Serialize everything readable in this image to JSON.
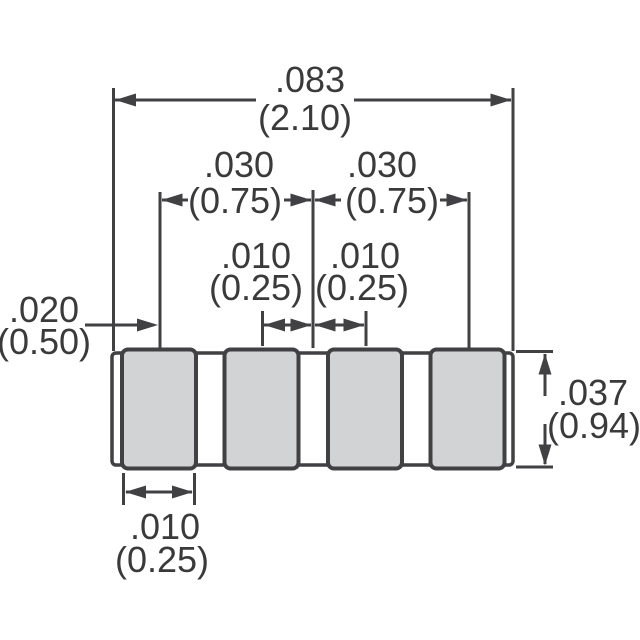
{
  "diagram": {
    "type": "mechanical-dimension-drawing",
    "subject": "4-terminal chip component, side view",
    "units_note": "inch values with (millimeter) values in parentheses",
    "component": {
      "pad_count": 4
    },
    "dimensions": {
      "overall_length": {
        "inch": ".083",
        "mm": "(2.10)"
      },
      "left_pitch": {
        "inch": ".030",
        "mm": "(0.75)"
      },
      "right_pitch": {
        "inch": ".030",
        "mm": "(0.75)"
      },
      "left_gap": {
        "inch": ".010",
        "mm": "(0.25)"
      },
      "right_gap": {
        "inch": ".010",
        "mm": "(0.25)"
      },
      "end_offset": {
        "inch": ".020",
        "mm": "(0.50)"
      },
      "body_height": {
        "inch": ".037",
        "mm": "(0.94)"
      },
      "pad_width": {
        "inch": ".010",
        "mm": "(0.25)"
      }
    },
    "colors": {
      "line": "#414144",
      "text": "#3a3a3a",
      "pad_fill": "#d2d3d5",
      "body_fill": "#ffffff",
      "background": "#ffffff"
    }
  }
}
